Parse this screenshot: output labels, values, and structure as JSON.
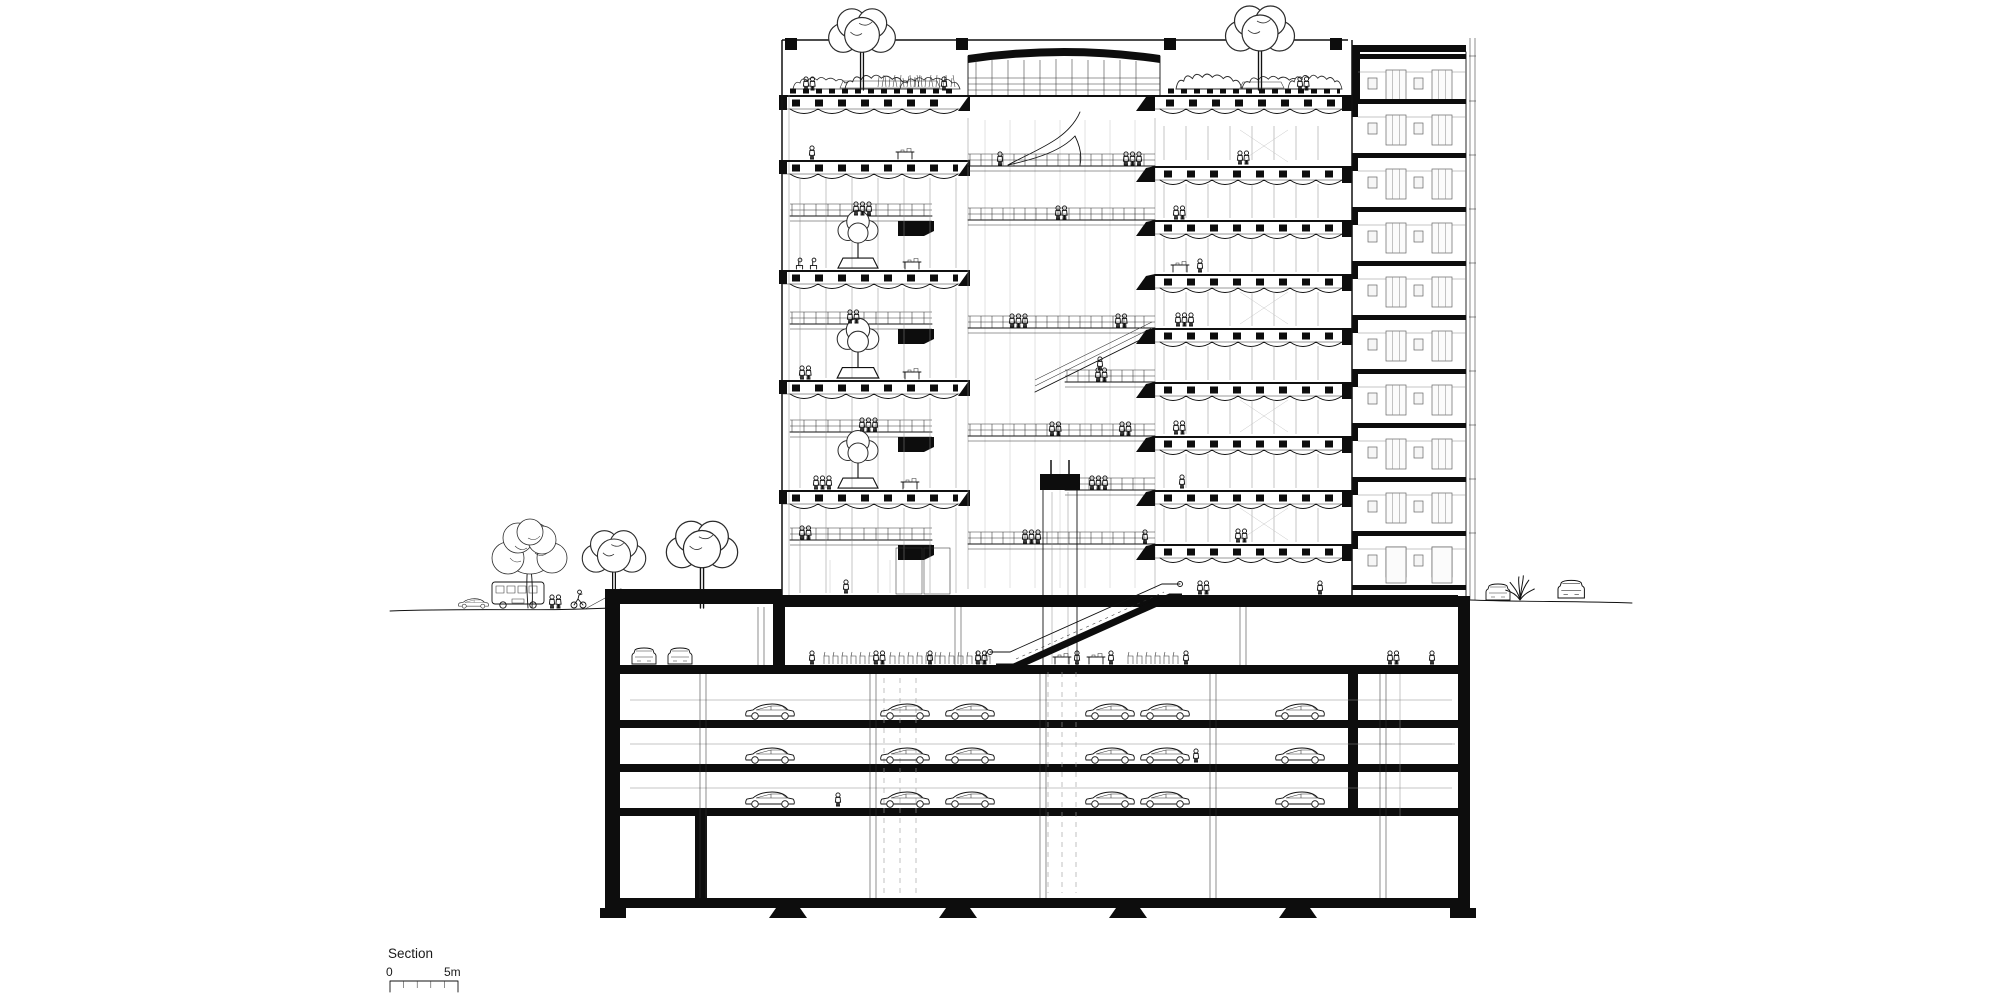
{
  "title_block": {
    "label": "Section",
    "scale_start": "0",
    "scale_end": "5m"
  },
  "palette": {
    "ink": "#0d0d0d",
    "paper": "#ffffff",
    "light_line": "#8a8a8a"
  },
  "drawing": {
    "type": "architectural-building-section",
    "above_ground": {
      "left_wing_double_height_levels": 4,
      "right_wing_levels": 9,
      "tower_elevation_levels": 10,
      "roof": [
        "roof garden with trees, shrubs and grasses",
        "central atrium skylight",
        "people on roof terrace"
      ],
      "atrium": [
        "walkway bridges with railings and people",
        "curved ramp sculpture",
        "diagonal ramp",
        "elevator shaft",
        "indoor trees in planters",
        "tables with people"
      ]
    },
    "below_ground": {
      "basement_levels": 5,
      "concourse": [
        "market seating rows",
        "stall tables",
        "people",
        "side parking alcove with two cars"
      ],
      "parking_levels": 3,
      "parked_cars_visible": 20,
      "escalator": "concourse to street level",
      "foundation": [
        "bottom slab",
        "pad footings",
        "partition walls"
      ]
    },
    "site": {
      "left_street": [
        "car",
        "bus",
        "three street trees",
        "pedestrian pair",
        "cyclist"
      ],
      "right_street": [
        "two parked cars front view",
        "grass tuft"
      ]
    }
  }
}
